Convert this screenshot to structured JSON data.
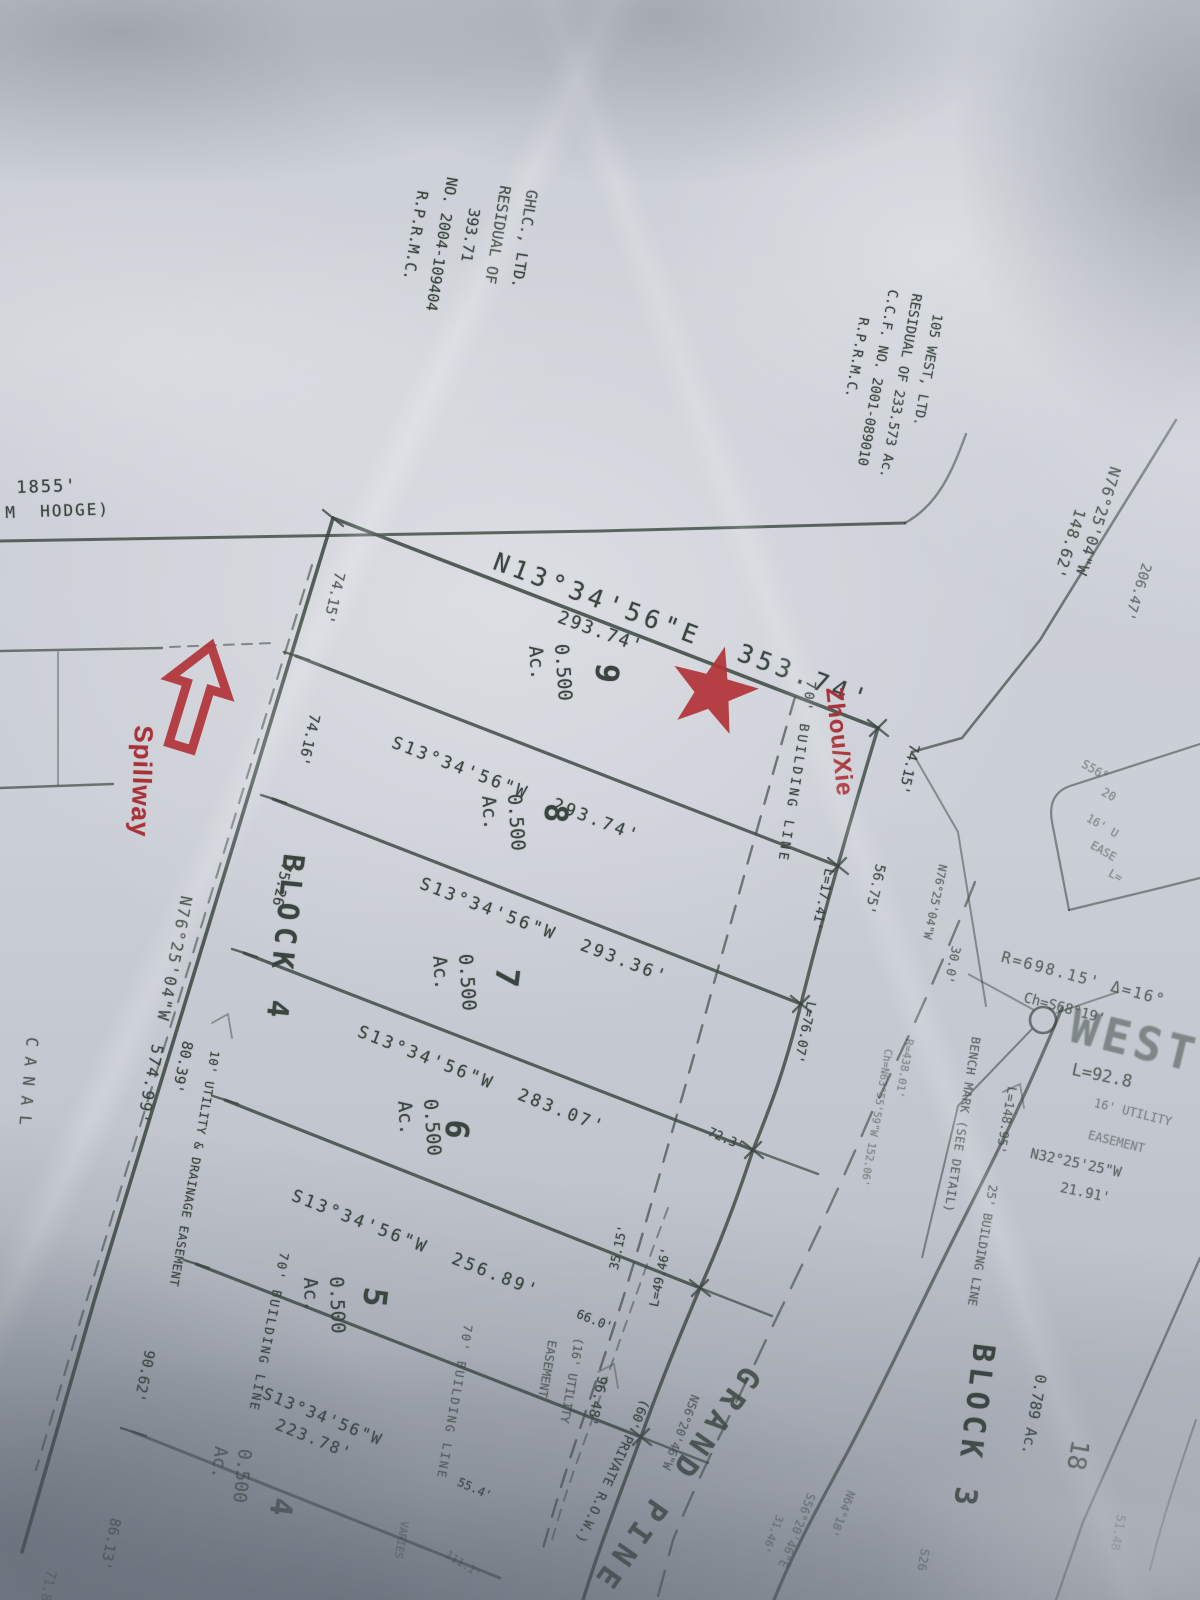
{
  "colors": {
    "ink": "#3a463f",
    "red_ink": "#a83237",
    "paper": "#c9cdd4"
  },
  "notes": {
    "hodge_dim": "1855'",
    "hodge_name": "M  HODGE)",
    "ghlc": "GHLC., LTD.\nRESIDUAL OF\n   393.71\nNO. 2004-109404\n  R.P.R.M.C.",
    "west105": "  105 WEST, LTD.\nRESIDUAL OF 233.573 Ac.\nC.C.F. NO. 2001-089010\n    R.P.R.M.C.",
    "canal": "CANAL",
    "bench_mark": "BENCH MARK (SEE DETAIL)"
  },
  "bearings": {
    "north_line": "N13°34'56\"E  353.74'",
    "lot9_south": "S13°34'56\"W  293.74'",
    "lot8_south": "S13°34'56\"W  293.36'",
    "lot7_south": "S13°34'56\"W  283.07'",
    "lot6_south": "S13°34'56\"W  256.89'",
    "lot5_south": "S13°34'56\"W\n  223.78'",
    "west_boundary": "N76°25'04\"W  574.99'",
    "top_right": "N76°25'04\"W",
    "top_right_dim": "148.62'",
    "right_small": "N76°25'04\"W",
    "n32": "N32°25'25\"W",
    "n32_dim": "21.91'",
    "road_nw": "N56°20'46\"W",
    "road_se": "S56°20'46\"E",
    "n64": "N64°18'",
    "s26": "S26"
  },
  "dims": {
    "d293_74": "293.74'",
    "d206_47": "206.47'",
    "d74_15_w": "74.15'",
    "d74_16": "74.16'",
    "d75_26": "75.26'",
    "d80_39": "80.39'",
    "d90_62": "90.62'",
    "d86_13": "86.13'",
    "d71_8": "71.8",
    "d74_15_e": "74.15'",
    "d56_75": "56.75'",
    "d72_3": "72.3'",
    "d66_0": "66.0'",
    "d55_4": "55.4'",
    "d35_15": "35.15'",
    "d30_0": "30.0'",
    "d96_48": "96.48'",
    "d111_1": "111.1'",
    "d31_46": "31.46'",
    "d51_48": "51.48",
    "varies": "VARIES"
  },
  "curves": {
    "l17_41": "L=17.41'",
    "l76_07": "L=76.07'",
    "l49_46": "L=49.46'",
    "l92_8": "L=92.8",
    "l148_95": "L=148.95'",
    "r698": "R=698.15' Δ=16°",
    "ch_s68": "Ch=S68°19'",
    "r438": "R=438.01'",
    "ch_n63": "Ch=N63°55'59\"W 152.06'"
  },
  "easements": {
    "bldg70_east": "70' BUILDING LINE",
    "bldg70_west": "70' BUILDING LINE",
    "bldg70_south": "70' BUILDING LINE",
    "bldg25": "25' BUILDING LINE",
    "util_drain10": "10' UTILITY & DRAINAGE EASEMENT",
    "util16_paren": "(16' UTILITY\n EASEMENT",
    "util16_right_a": "16' UTILITY",
    "util16_right_b": "EASEMENT"
  },
  "road": {
    "name": "GRAND PINE",
    "row": "(60' PRIVATE R.O.W.)",
    "west_stamp": "WEST"
  },
  "shape_labels": {
    "s56": "S56°",
    "n20": "20",
    "u16": "16' U",
    "ease": "EASE",
    "l_eq": "L="
  },
  "blocks": {
    "block4": "BLOCK 4",
    "block3": "BLOCK 3"
  },
  "lots": {
    "lot9": {
      "number": "9",
      "area": "0.500\nAc."
    },
    "lot8": {
      "number": "8",
      "area": "0.500\nAc."
    },
    "lot7": {
      "number": "7",
      "area": "0.500\nAc."
    },
    "lot6": {
      "number": "6",
      "area": "0.500\nAc."
    },
    "lot5": {
      "number": "5",
      "area": "0.500\nAc."
    },
    "lot4": {
      "number": "4",
      "area": "0.500\nAc."
    },
    "lot18": {
      "number": "18",
      "area": "0.789 Ac."
    }
  },
  "red": {
    "owner": "Zhou/Xie",
    "spillway": "Spillway"
  }
}
